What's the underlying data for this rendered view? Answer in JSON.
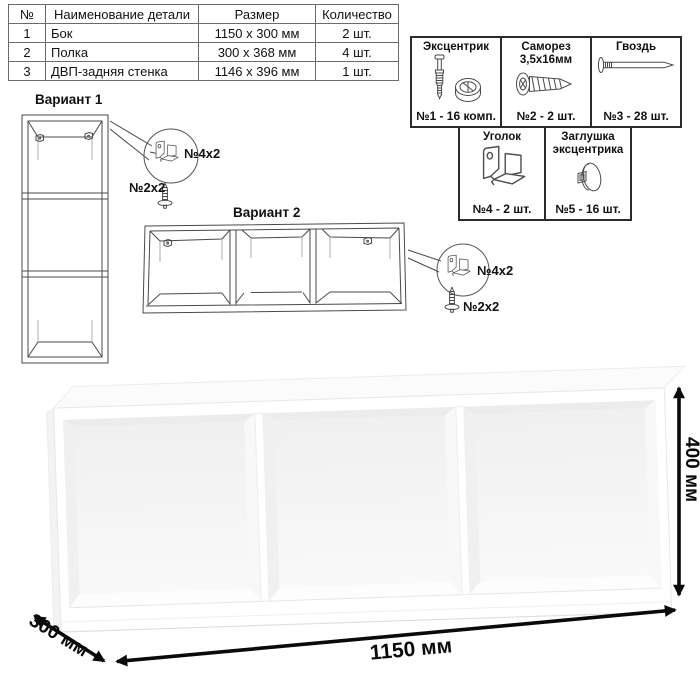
{
  "parts_table": {
    "headers": [
      "№",
      "Наименование детали",
      "Размер",
      "Количество"
    ],
    "rows": [
      {
        "num": "1",
        "name": "Бок",
        "size": "1150 x 300 мм",
        "qty": "2 шт."
      },
      {
        "num": "2",
        "name": "Полка",
        "size": "300 x 368 мм",
        "qty": "4 шт."
      },
      {
        "num": "3",
        "name": "ДВП-задняя стенка",
        "size": "1146 x 396 мм",
        "qty": "1 шт."
      }
    ]
  },
  "hardware": {
    "items": [
      {
        "name": "Эксцентрик",
        "count": "№1 - 16 комп.",
        "icon": "eccentric-cam-icon"
      },
      {
        "name": "Саморез 3,5х16мм",
        "count": "№2 - 2 шт.",
        "icon": "screw-icon"
      },
      {
        "name": "Гвоздь",
        "count": "№3 - 28 шт.",
        "icon": "nail-icon"
      },
      {
        "name": "Уголок",
        "count": "№4 - 2 шт.",
        "icon": "corner-bracket-icon"
      },
      {
        "name": "Заглушка эксцентрика",
        "count": "№5 - 16 шт.",
        "icon": "cam-cap-icon"
      }
    ]
  },
  "variants": [
    {
      "title": "Вариант 1",
      "bracket_label": "№4х2",
      "screw_label": "№2х2"
    },
    {
      "title": "Вариант 2",
      "bracket_label": "№4х2",
      "screw_label": "№2х2"
    }
  ],
  "dimensions": {
    "width": "1150 мм",
    "depth": "300 мм",
    "height": "400 мм"
  },
  "colors": {
    "text": "#111111",
    "line_art": "#4a4a4a",
    "dimension": "#0a0a0a",
    "render": "#ffffff"
  }
}
